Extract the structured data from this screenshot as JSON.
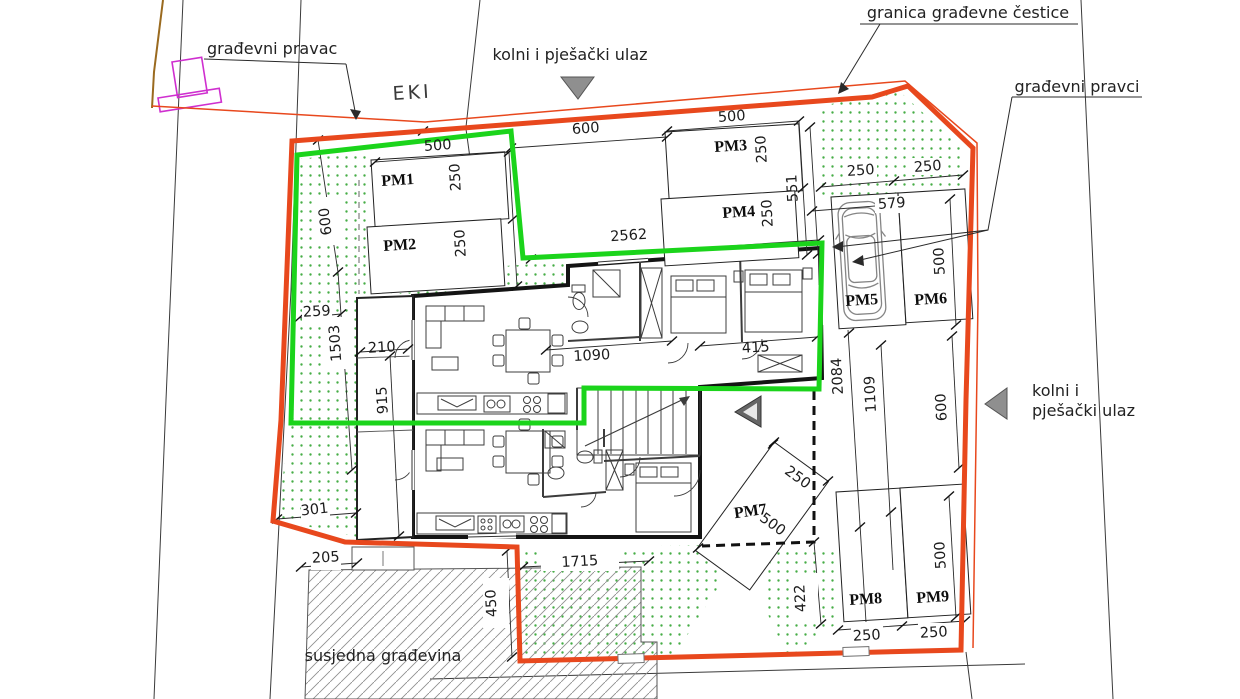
{
  "labels": {
    "building_line": "građevni pravac",
    "entrance_top": "kolni i pješački ulaz",
    "boundary": "granica građevne čestice",
    "building_lines": "građevni pravci",
    "entrance_right_1": "kolni i",
    "entrance_right_2": "pješački ulaz",
    "neighbor_building": "susjedna građevina",
    "road": "EKI"
  },
  "parking": [
    "PM1",
    "PM2",
    "PM3",
    "PM4",
    "PM5",
    "PM6",
    "PM7",
    "PM8",
    "PM9"
  ],
  "dims": [
    "500",
    "250",
    "250",
    "600",
    "500",
    "250",
    "250",
    "551",
    "2562",
    "250",
    "250",
    "579",
    "500",
    "600",
    "259",
    "1503",
    "210",
    "915",
    "1090",
    "415",
    "2084",
    "1109",
    "600",
    "301",
    "205",
    "450",
    "1715",
    "250",
    "500",
    "422",
    "500",
    "250",
    "250"
  ],
  "colors": {
    "plot_boundary": "#e8481d",
    "building_line_green": "#1bd41b",
    "hatch_dot_green": "#46ad46",
    "wall_black": "#141414",
    "parcel_line": "#3a3a3a",
    "object_magenta": "#cf2fcf",
    "road_edge_brown": "#9a6a1f",
    "entrance_arrow_gray": "#8f8f8f"
  }
}
